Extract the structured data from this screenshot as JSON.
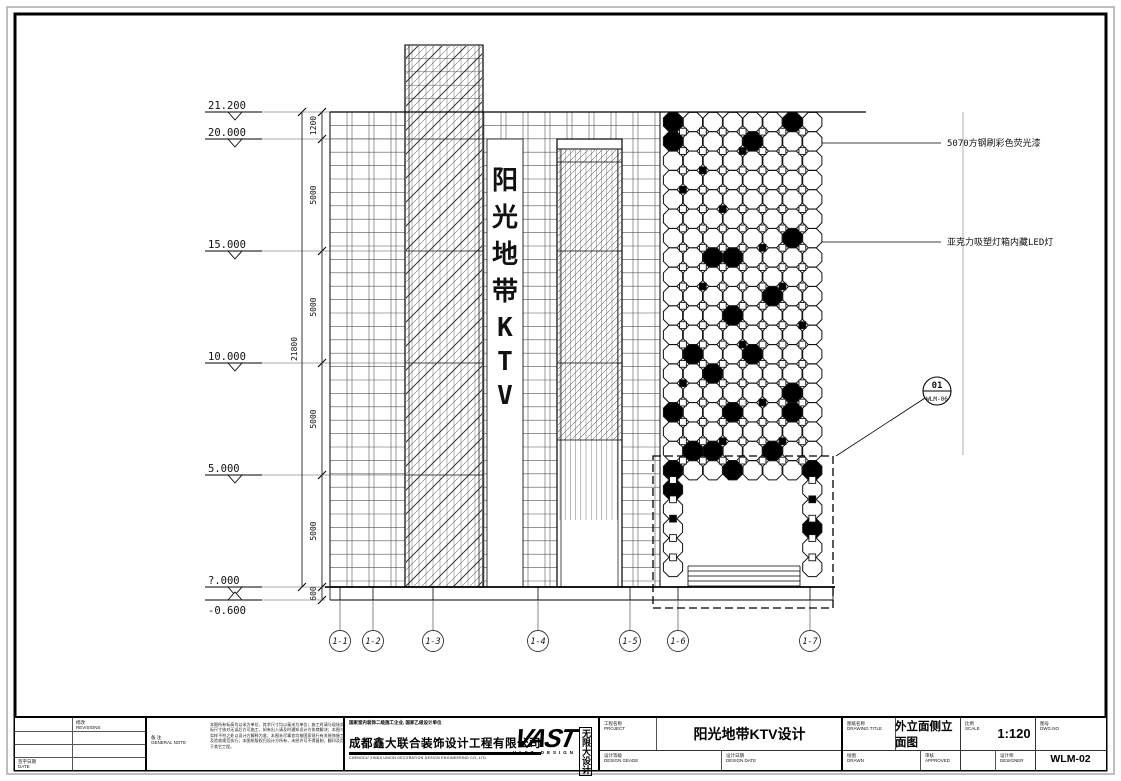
{
  "drawing": {
    "sign_chars": [
      "阳",
      "光",
      "地",
      "带",
      "K",
      "T",
      "V"
    ],
    "elevation_marks": [
      "21.200",
      "20.000",
      "15.000",
      "10.000",
      "5.000",
      "?.000",
      "-0.600"
    ],
    "dims": {
      "segments": [
        "1200",
        "5000",
        "5000",
        "5000",
        "5000",
        "600"
      ],
      "overall": "21800"
    },
    "grid_bubbles": [
      "1-1",
      "1-2",
      "1-3",
      "1-4",
      "1-5",
      "1-6",
      "1-7"
    ],
    "annotations": [
      "5070方钢刷彩色荧光漆",
      "亚克力吸塑灯箱内藏LED灯"
    ],
    "detail_callout": {
      "number": "01",
      "sheet": "WLM-06"
    }
  },
  "title_block": {
    "revisions": {
      "cn": "修改",
      "en": "REVISIONS"
    },
    "date": {
      "cn": "签字日期",
      "en": "DATE"
    },
    "general_note": {
      "cn": "备 注",
      "en": "GENERAL NOTE",
      "text": "本图所有标高均以米为单位，其余尺寸均以毫米为单位；施工时请与现场实际尺寸核对无误后方可施工，如有出入请及时通知设计方协商解决；本图与实样不符之处以设计方解释为准；本图未尽事宜均按国家现行有关装饰施工及验收规范执行；本图纸版权归设计方所有，未经许可不得复制、翻印及用于其它工程。"
    },
    "company": {
      "qualification": "国家室内装饰二级施工企业, 国家乙级设计单位",
      "name": "成都鑫大联合装饰设计工程有限公司",
      "name_en": "CHENGDU XINDA UNION DECORATION DESIGN ENGINEERING CO.,LTD.",
      "logo": "VAST",
      "logo_sub": "VAST DESIGN",
      "logo_cn": "无限大设计"
    },
    "project": {
      "cn": "工程名称",
      "en": "PROJECT",
      "value": "阳光地带KTV设计"
    },
    "design_grade": {
      "cn": "设计等级",
      "en": "DESIGN GEADE"
    },
    "design_date": {
      "cn": "设计日期",
      "en": "DESIGN DATE"
    },
    "drawing_title": {
      "cn": "图纸名称",
      "en": "DRAWING TITLE",
      "value": "外立面侧立面图"
    },
    "drawn": {
      "cn": "绘图",
      "en": "DRAWN"
    },
    "approved": {
      "cn": "审核",
      "en": "APPROVED"
    },
    "designer": {
      "cn": "设计师",
      "en": "DESIGNER"
    },
    "scale": {
      "cn": "比例",
      "en": "SCALE",
      "value": "1:120"
    },
    "dwg_no": {
      "cn": "图号",
      "en": "DWG.NO",
      "value": "WLM-02"
    }
  }
}
